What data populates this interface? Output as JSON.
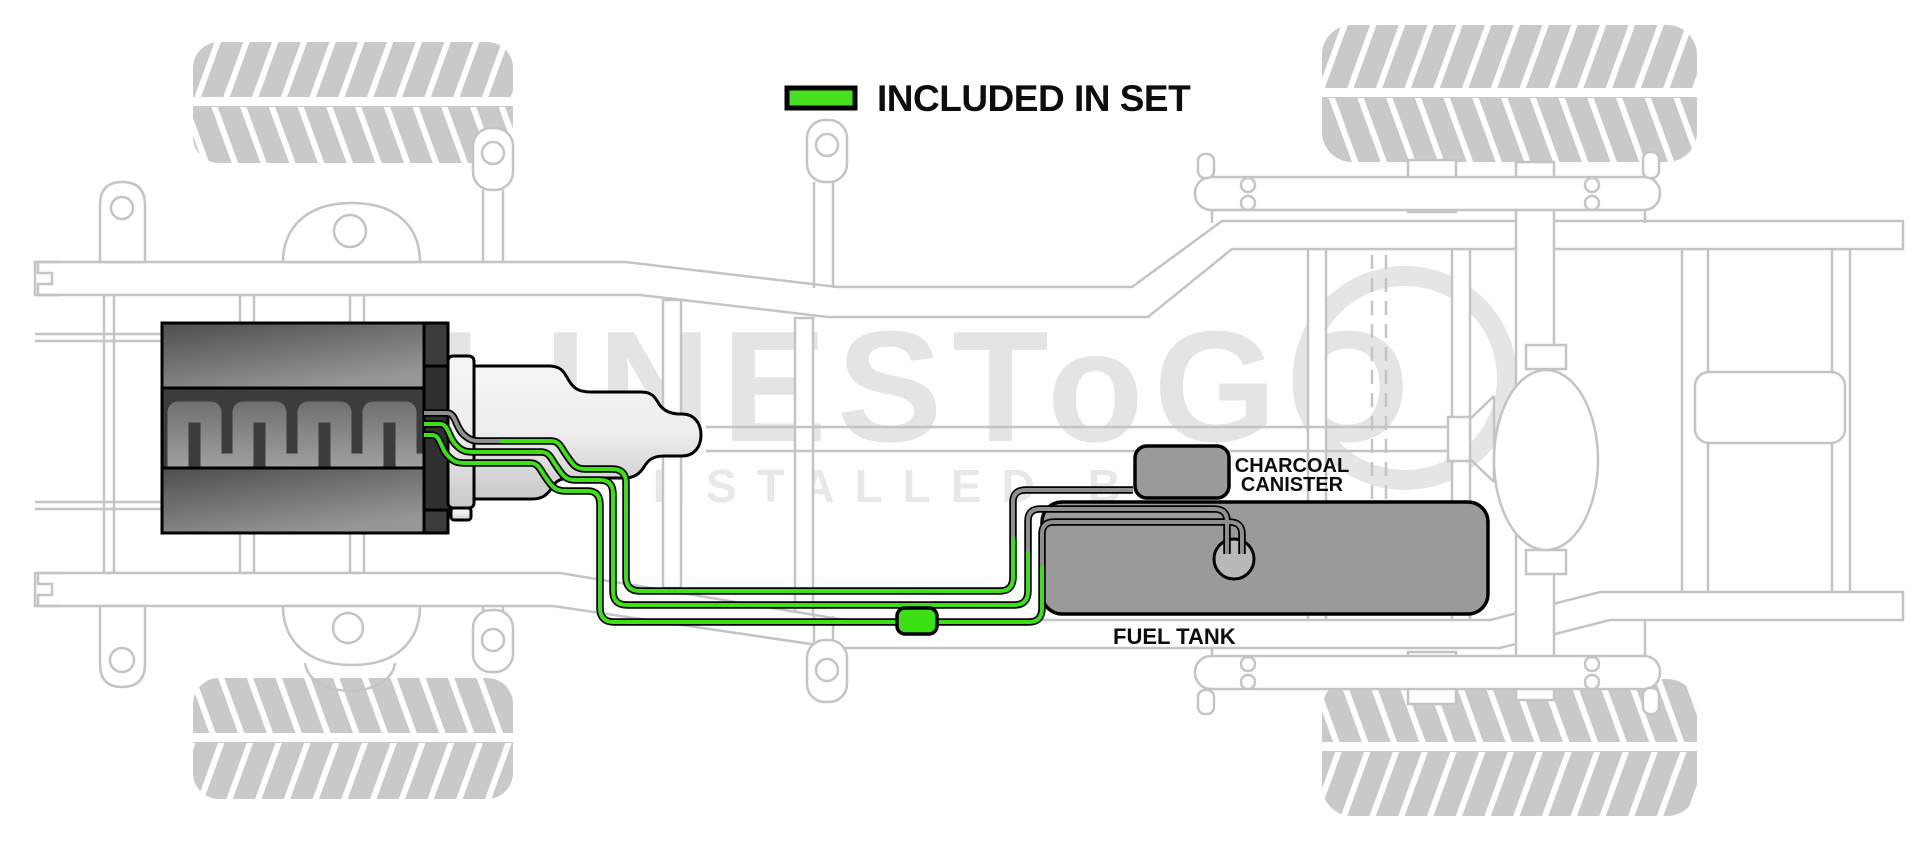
{
  "legend": {
    "label": "INCLUDED IN SET",
    "swatch_color": "#46E01E"
  },
  "labels": {
    "canister_line1": "CHARCOAL",
    "canister_line2": "CANISTER",
    "fuel_tank": "FUEL TANK"
  },
  "watermark": {
    "brand": "LINESToGO",
    "installed_by": "INSTALLED BY"
  },
  "colors": {
    "included_line_green": "#3BE015",
    "excluded_line_gray": "#8F8F8F",
    "line_casing_black": "#000000",
    "tank_gray": "#9A9A9A",
    "pump_gray": "#B9B9B9",
    "canister_gray": "#9A9A9A",
    "frame_outline_gray": "#C4C4C4",
    "tire_gray": "#C9C9C9",
    "watermark_gray": "#E4E4E4",
    "legend_text_black": "#0D0D0D"
  }
}
